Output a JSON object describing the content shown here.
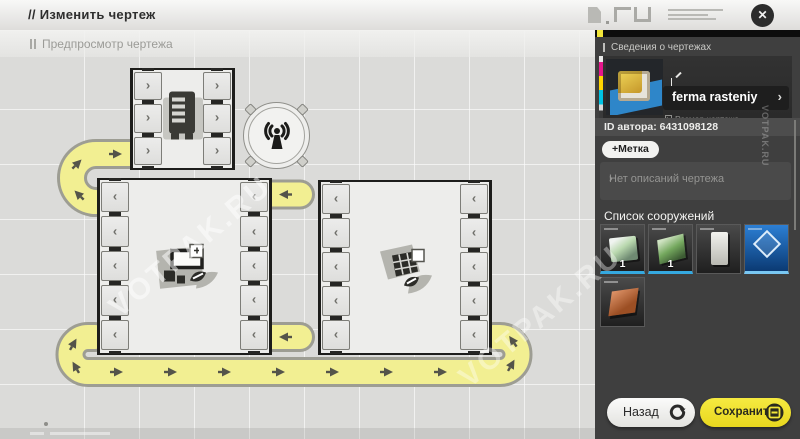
{
  "window": {
    "title": "// Изменить чертеж"
  },
  "canvas": {
    "preview_label": "Предпросмотр чертежа",
    "boxes": [
      {
        "id": "fabricator-box",
        "left": 130,
        "top": 38,
        "width": 105,
        "height": 102,
        "rows": 3,
        "chevron": "›",
        "icon": "fabricator"
      },
      {
        "id": "planter-box-left",
        "left": 97,
        "top": 148,
        "width": 175,
        "height": 177,
        "rows": 5,
        "chevron": "‹",
        "icon": "seed"
      },
      {
        "id": "planter-box-right",
        "left": 318,
        "top": 150,
        "width": 174,
        "height": 175,
        "rows": 5,
        "chevron": "‹",
        "icon": "solar"
      }
    ]
  },
  "sidebar": {
    "info_title": "Сведения о чертежах",
    "blueprint_name": "ferma rasteniy",
    "size_label": "Размер чертежа",
    "size_value": "13×9",
    "author_id": "ID автора: 6431098128",
    "tag_button_label": "+Метка",
    "description_placeholder": "Нет описаний чертежа",
    "structures_title": "Список сооружений",
    "structures": [
      {
        "name": "growth-chamber-thumb",
        "variant": "growth",
        "count": "1",
        "accent": "#35a9e0"
      },
      {
        "name": "circuit-planter-thumb",
        "variant": "circuit",
        "count": "1",
        "accent": "#35a9e0"
      },
      {
        "name": "silo-tower-thumb",
        "variant": "tower",
        "count": "",
        "accent": ""
      },
      {
        "name": "power-pylon-thumb",
        "variant": "pylon",
        "count": "",
        "accent": "#79c7f2"
      },
      {
        "name": "copper-panel-thumb",
        "variant": "copper",
        "count": "",
        "accent": ""
      }
    ]
  },
  "footer": {
    "back_label": "Назад",
    "save_label": "Сохранить"
  },
  "icons": {
    "close": "✕",
    "chevron_right": "›"
  },
  "watermark": "VOTPAK.RU",
  "colors": {
    "accent_yellow": "#f2e63a",
    "belt_yellow": "#f2ef92",
    "panel_dark": "#3f3f3f",
    "blueprint_blue": "#2e86c9"
  }
}
